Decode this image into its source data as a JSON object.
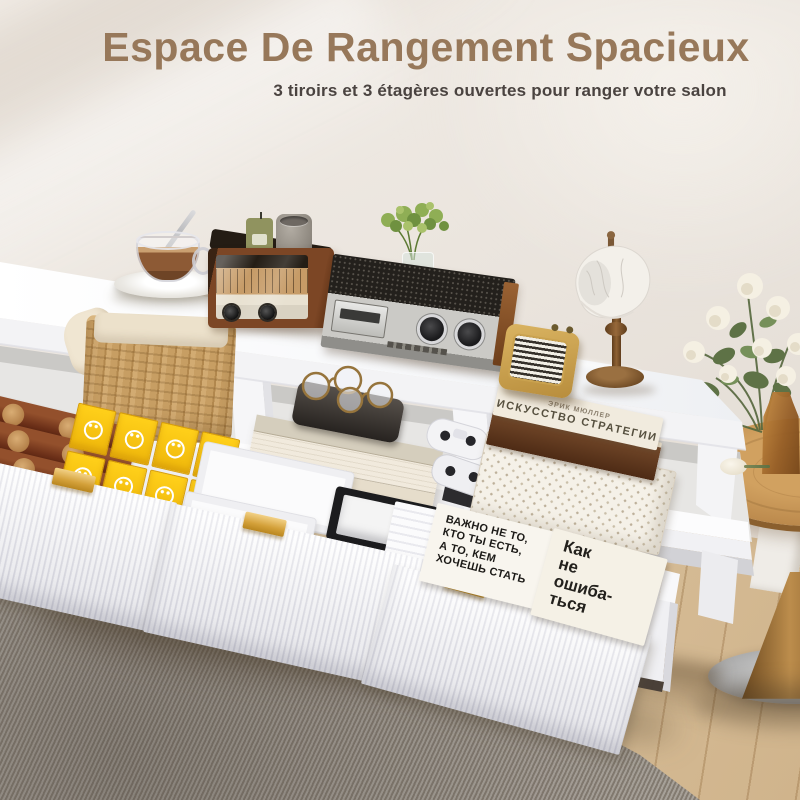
{
  "header": {
    "title": "Espace De Rangement Spacieux",
    "subtitle": "3 tiroirs et 3 étagères ouvertes pour ranger votre salon"
  },
  "palette": {
    "title_brown": "#97785a",
    "subtitle_gray": "#4a4340",
    "wall_cream": "#ece7e0",
    "floor_oak": "#d9c2a0",
    "rug_gray": "#9a9289",
    "handle_gold": "#d9a84b",
    "snack_yellow": "#f7c913",
    "wood_brown": "#7c4625"
  },
  "scene": {
    "counts": {
      "drawers": 3,
      "open_shelves": 3
    },
    "shelf_book": {
      "author": "ЭРИК МЮЛЛЕР",
      "title": "ИСКУССТВО СТРАТЕГИИ"
    },
    "drawer_book_big": {
      "lines": [
        "ВАЖНО НЕ ТО,",
        "КТО ТЫ ЕСТЬ,",
        "А ТО, КЕМ",
        "ХОЧЕШЬ СТАТЬ"
      ]
    },
    "drawer_book_small": {
      "lines": [
        "Как",
        "не",
        "ошиба-",
        "ться"
      ]
    }
  }
}
